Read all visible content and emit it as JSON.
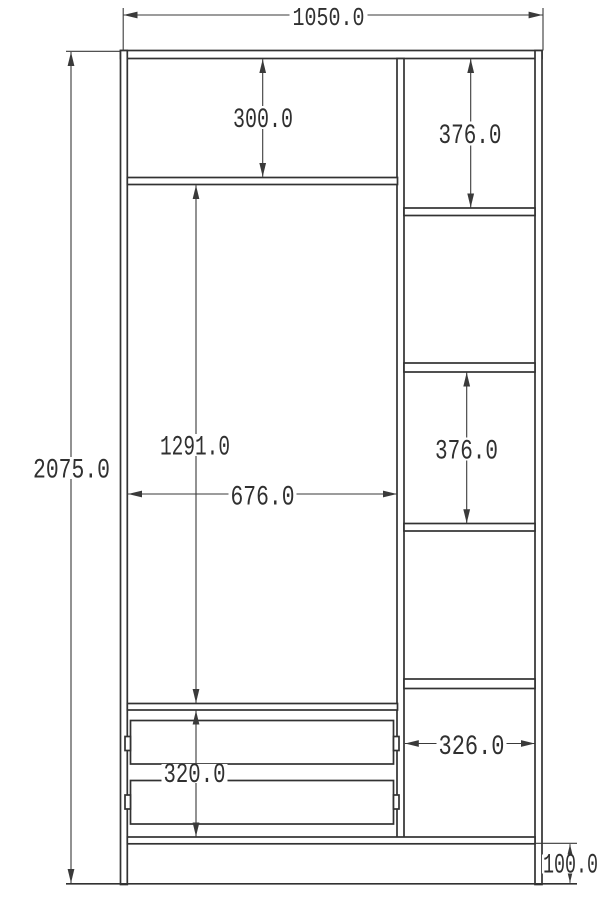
{
  "drawing": {
    "kind": "wardrobe front-view dimension drawing",
    "dims": {
      "overall_width": "1050.0",
      "overall_height": "2075.0",
      "top_compartment_height": "300.0",
      "right_top_section_height": "376.0",
      "main_compartment_height": "1291.0",
      "main_compartment_width": "676.0",
      "right_middle_section_height": "376.0",
      "drawer_section_height": "320.0",
      "right_column_width": "326.0",
      "plinth_height": "100.0"
    }
  }
}
